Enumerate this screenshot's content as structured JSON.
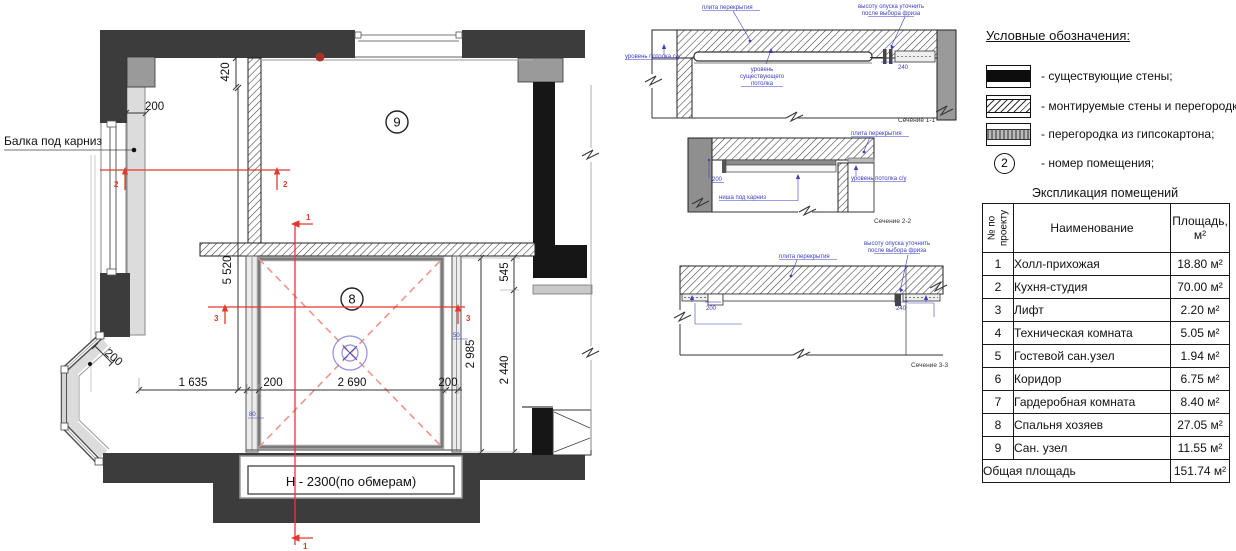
{
  "plan": {
    "beam_label": "Балка под карниз",
    "height_label": "Н - 2300(по обмерам)",
    "room_numbers": {
      "r8": "8",
      "r9": "9"
    },
    "dims": {
      "d420": "420",
      "d200_top": "200",
      "d5520": "5 520",
      "d200_bay": "200",
      "d1635": "1 635",
      "d200_left": "200",
      "d2690": "2 690",
      "d200_right": "200",
      "d2985": "2 985",
      "d2440": "2 440",
      "d545": "545",
      "d80": "80",
      "d50": "50"
    },
    "section_marks": {
      "m1": "1",
      "m2": "2",
      "m3": "3"
    }
  },
  "sections": {
    "s1": {
      "name": "Сечение 1-1",
      "slab_label": "плита перекрытия",
      "drop_note_line1": "высоту опуска уточнить",
      "drop_note_line2": "после выбора фриза",
      "su_ceiling_label": "уровень потолка с/у",
      "exist_ceiling_line1": "уровень",
      "exist_ceiling_line2": "существующего",
      "exist_ceiling_line3": "потолка",
      "dim_240": "240"
    },
    "s2": {
      "name": "Сечение 2-2",
      "slab_label": "плита перекрытия",
      "dim_200": "200",
      "niche_label": "ниша под карниз",
      "su_ceiling_label": "уровень потолка с/у"
    },
    "s3": {
      "name": "Сечение 3-3",
      "slab_label": "плита перекрытия",
      "drop_note_line1": "высоту опуска уточнить",
      "drop_note_line2": "после выбора фриза",
      "dim_200": "200",
      "dim_240": "240"
    }
  },
  "legend": {
    "title": "Условные обозначения:",
    "items": [
      {
        "key": "existing-walls",
        "label": "- существующие стены;"
      },
      {
        "key": "mounted-walls",
        "label": "- монтируемые стены и перегородки;"
      },
      {
        "key": "drywall-partition",
        "label": "- перегородка из гипсокартона;"
      },
      {
        "key": "room-number",
        "label": "- номер помещения;",
        "symbol": "2"
      }
    ]
  },
  "table": {
    "title": "Экспликация помещений",
    "headers": {
      "num": "№ по проекту",
      "name": "Наименование",
      "area": "Площадь, м²"
    },
    "rows": [
      {
        "num": "1",
        "name": "Холл-прихожая",
        "area": "18.80 м²"
      },
      {
        "num": "2",
        "name": "Кухня-студия",
        "area": "70.00 м²"
      },
      {
        "num": "3",
        "name": "Лифт",
        "area": "2.20 м²"
      },
      {
        "num": "4",
        "name": "Техническая комната",
        "area": "5.05 м²"
      },
      {
        "num": "5",
        "name": "Гостевой сан.узел",
        "area": "1.94 м²"
      },
      {
        "num": "6",
        "name": "Коридор",
        "area": "6.75 м²"
      },
      {
        "num": "7",
        "name": "Гардеробная комната",
        "area": "8.40 м²"
      },
      {
        "num": "8",
        "name": "Спальня хозяев",
        "area": "27.05 м²"
      },
      {
        "num": "9",
        "name": "Сан. узел",
        "area": "11.55 м²"
      }
    ],
    "total": {
      "label": "Общая площадь",
      "area": "151.74 м²"
    }
  },
  "colors": {
    "section_cut_red": "#e23b2e",
    "diagonal_dash_red": "#f0958b",
    "annotation_blue": "#3d3ec0",
    "wall_dark": "#3c3c3c",
    "wall_black": "#161616"
  }
}
